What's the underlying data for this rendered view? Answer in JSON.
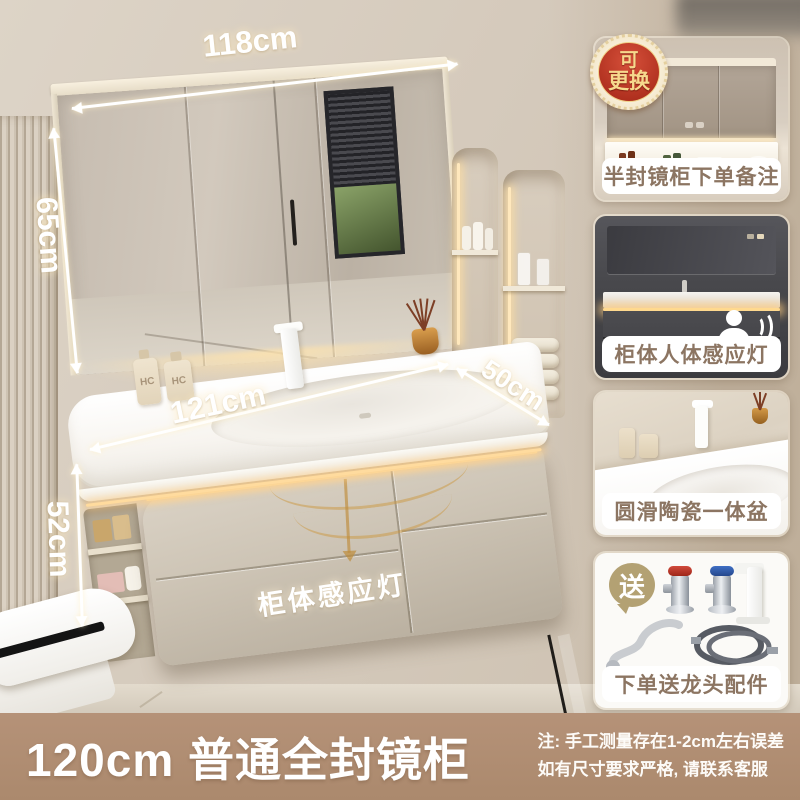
{
  "annotations": {
    "mirror_width": "118cm",
    "mirror_height": "65cm",
    "counter_width": "121cm",
    "cabinet_height": "52cm",
    "counter_depth": "50cm",
    "cabinet_light": "柜体感应灯",
    "bottle_label": "HC"
  },
  "badge": {
    "line1": "可",
    "line2": "更换"
  },
  "side_panels": [
    {
      "caption": "半封镜柜下单备注"
    },
    {
      "caption": "柜体人体感应灯"
    },
    {
      "caption": "圆滑陶瓷一体盆"
    },
    {
      "caption": "下单送龙头配件",
      "gift_badge": "送"
    }
  ],
  "banner": {
    "title": "120cm 普通全封镜柜",
    "note_line1": "注: 手工测量存在1-2cm左右误差",
    "note_line2": "如有尺寸要求严格, 请联系客服"
  },
  "colors": {
    "banner_bg": "#b29078",
    "caption_text": "#8c7562",
    "badge_red": "#b1301f",
    "badge_gold": "#f6d98d",
    "led_warm": "#ffd98e",
    "wall_beige": "#d5cabc"
  }
}
